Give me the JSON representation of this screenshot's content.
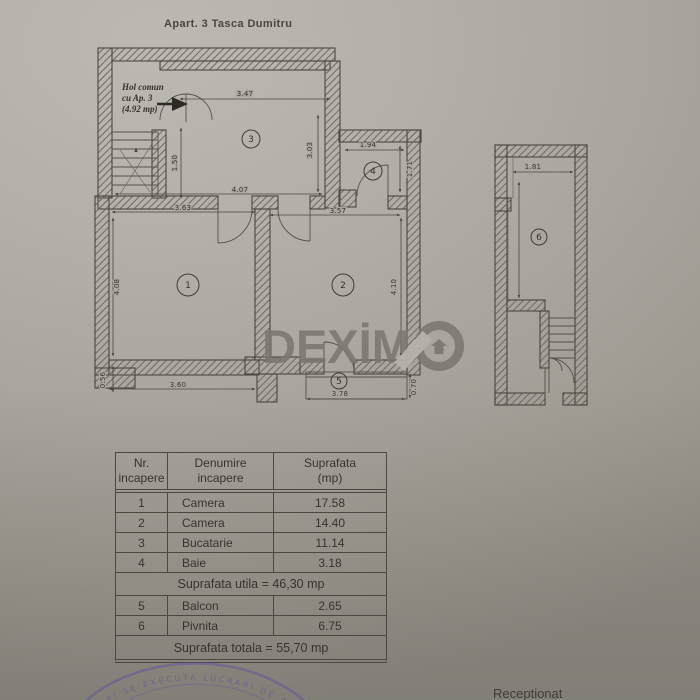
{
  "page": {
    "title": "Apart. 3 Tasca Dumitru",
    "receptionat_label": "Receptionat"
  },
  "hol_label": {
    "line1": "Hol comun",
    "line2": "cu Ap. 3",
    "line3": "(4.92 mp)"
  },
  "watermark": {
    "text": "DEXİM",
    "icon": "house-in-circle",
    "color": "#7a7670"
  },
  "stamp": {
    "text": "CPI SE EXECUTA LUCRARI DE CAD",
    "color": "#60529e"
  },
  "plan": {
    "rooms": {
      "r1": "1",
      "r2": "2",
      "r3": "3",
      "r4": "4",
      "r5": "5",
      "r6": "6"
    },
    "dims": {
      "d347": "3.47",
      "d150": "1.50",
      "d407": "4.07",
      "d194": "1.94",
      "d171": "1.71",
      "d303": "3.03",
      "d363": "3.63",
      "d357": "3.57",
      "d408": "4.08",
      "d410": "4.10",
      "d056": "0.56",
      "d360": "3.60",
      "d378": "3.78",
      "d070": "0.70",
      "d181": "1.81"
    }
  },
  "table": {
    "headers": {
      "c1l1": "Nr.",
      "c1l2": "incapere",
      "c2l1": "Denumire",
      "c2l2": "incapere",
      "c3l1": "Suprafata",
      "c3l2": "(mp)"
    },
    "rows_a": [
      {
        "nr": "1",
        "name": "Camera",
        "area": "17.58"
      },
      {
        "nr": "2",
        "name": "Camera",
        "area": "14.40"
      },
      {
        "nr": "3",
        "name": "Bucatarie",
        "area": "11.14"
      },
      {
        "nr": "4",
        "name": "Baie",
        "area": "3.18"
      }
    ],
    "utila": "Suprafata utila = 46,30 mp",
    "rows_b": [
      {
        "nr": "5",
        "name": "Balcon",
        "area": "2.65"
      },
      {
        "nr": "6",
        "name": "Pivnita",
        "area": "6.75"
      }
    ],
    "totala": "Suprafata totala = 55,70 mp"
  },
  "colors": {
    "ink": "#45423c",
    "paper": "#aeaaa3"
  }
}
